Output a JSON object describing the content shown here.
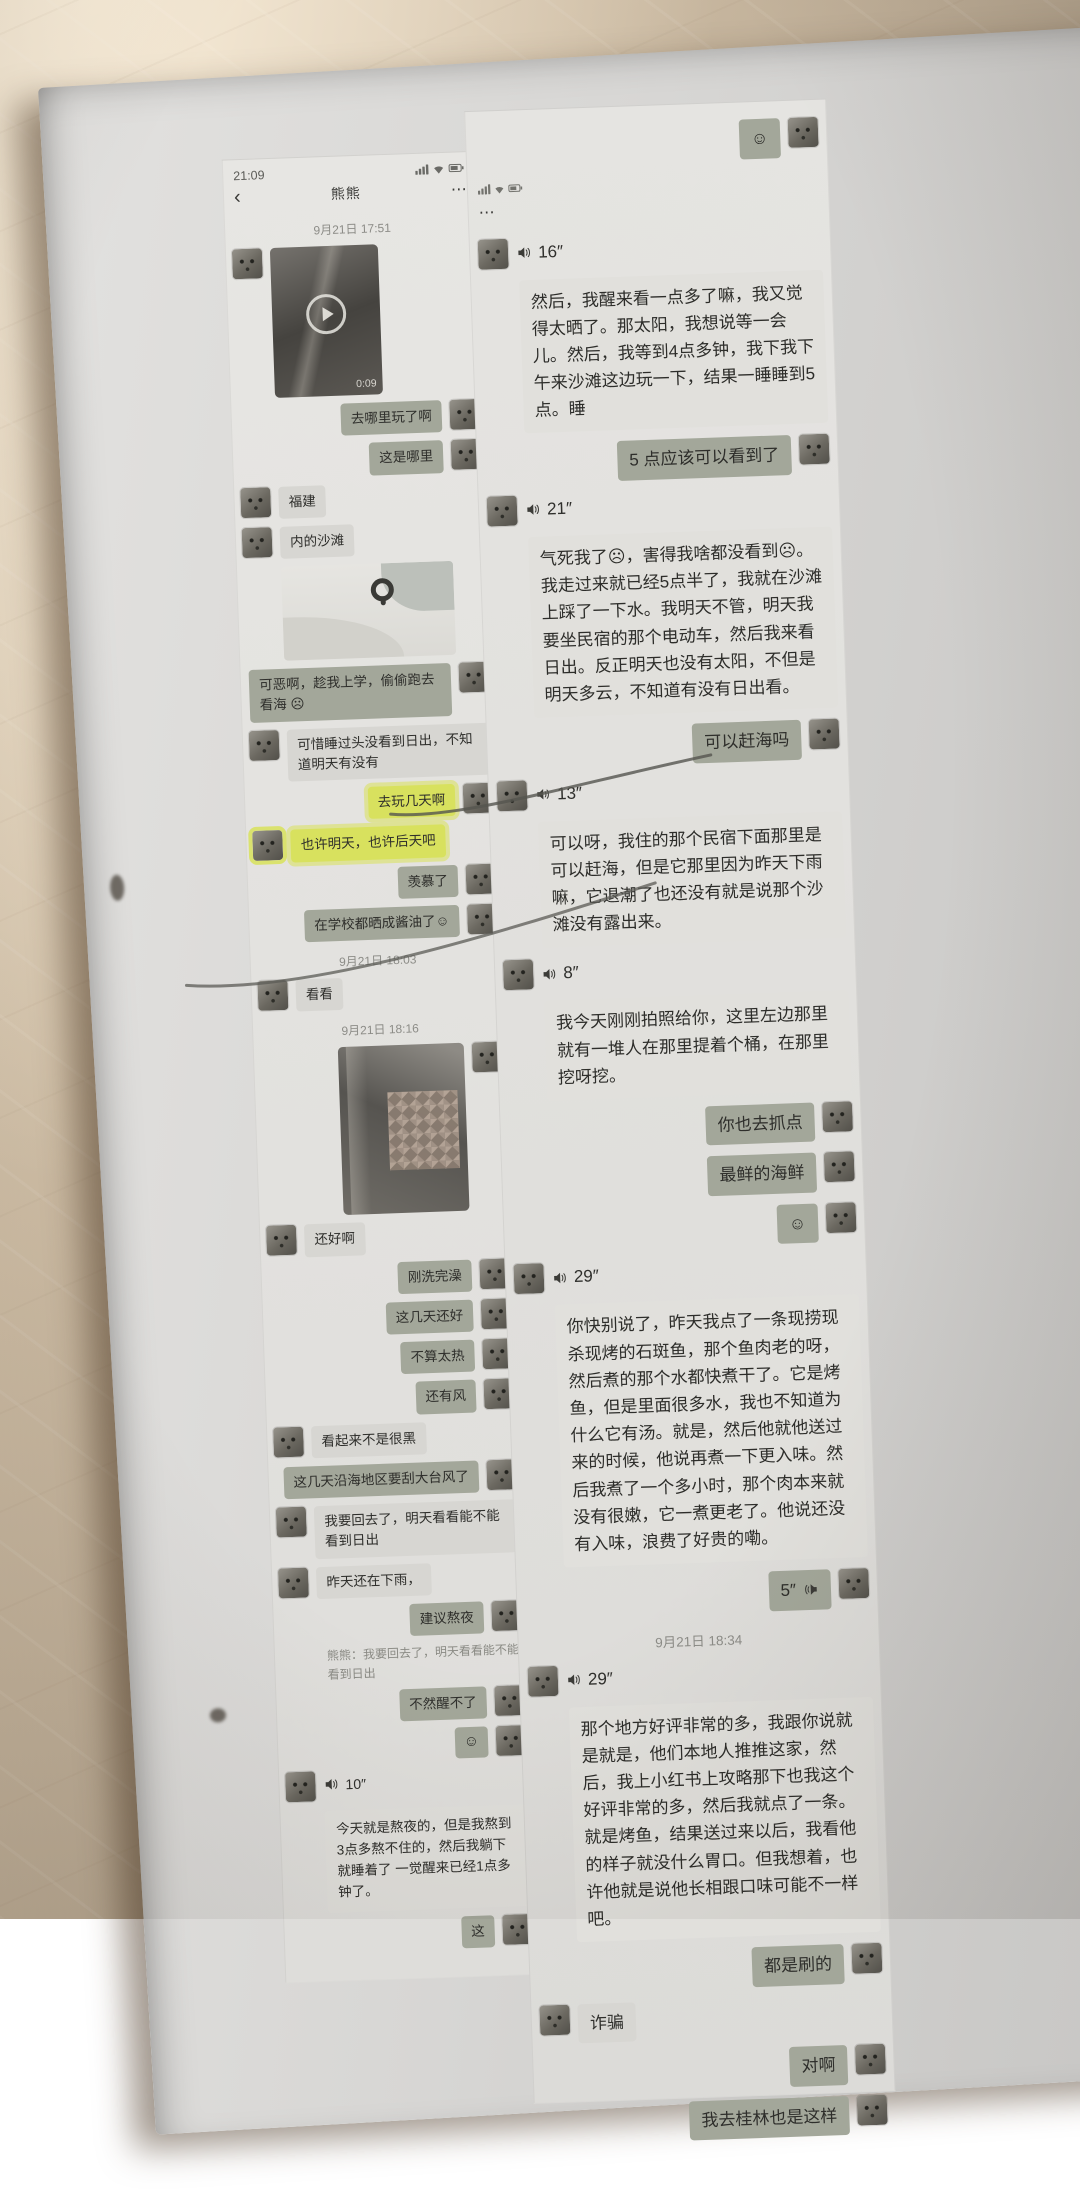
{
  "colors": {
    "table": "#c4b29b",
    "paper": "#d9d8d5",
    "highlighter": "#d8e15e",
    "bubble_in": "#d7d6d2",
    "bubble_out": "#a3a79a"
  },
  "left_chat": {
    "status_time": "21:09",
    "nav": {
      "back": "‹",
      "title": "熊熊",
      "menu": "⋯"
    },
    "messages": [
      {
        "type": "time",
        "text": "9月21日 17:51"
      },
      {
        "type": "video-in",
        "duration": "0:09"
      },
      {
        "type": "out",
        "text": "去哪里玩了啊"
      },
      {
        "type": "out",
        "text": "这是哪里"
      },
      {
        "type": "in",
        "text": "福建"
      },
      {
        "type": "in",
        "text": "内的沙滩"
      },
      {
        "type": "map-in"
      },
      {
        "type": "out",
        "text": "可恶啊，趁我上学，偷偷跑去看海 ☹"
      },
      {
        "type": "in",
        "text": "可惜睡过头没看到日出，不知道明天有没有"
      },
      {
        "type": "out",
        "text": "去玩几天啊",
        "highlight": true
      },
      {
        "type": "in",
        "text": "也许明天，也许后天吧",
        "highlight": true
      },
      {
        "type": "out",
        "text": "羡慕了"
      },
      {
        "type": "out",
        "text": "在学校都晒成酱油了☺"
      },
      {
        "type": "time",
        "text": "9月21日 18:03"
      },
      {
        "type": "in",
        "text": "看看"
      },
      {
        "type": "time",
        "text": "9月21日 18:16"
      },
      {
        "type": "photo-out"
      },
      {
        "type": "in",
        "text": "还好啊"
      },
      {
        "type": "out",
        "text": "刚洗完澡"
      },
      {
        "type": "out",
        "text": "这几天还好"
      },
      {
        "type": "out",
        "text": "不算太热"
      },
      {
        "type": "out",
        "text": "还有风"
      },
      {
        "type": "in",
        "text": "看起来不是很黑"
      },
      {
        "type": "out",
        "text": "这几天沿海地区要刮大台风了"
      },
      {
        "type": "in",
        "text": "我要回去了，明天看看能不能看到日出"
      },
      {
        "type": "in",
        "text": "昨天还在下雨，"
      },
      {
        "type": "out",
        "text": "建议熬夜"
      },
      {
        "type": "quote",
        "text": "熊熊：我要回去了，明天看看能不能看到日出"
      },
      {
        "type": "out",
        "text": "不然醒不了"
      },
      {
        "type": "out",
        "text": "☺",
        "emoji": true
      },
      {
        "type": "voice-in",
        "dur": "10″",
        "text": "今天就是熬夜的，但是我熬到3点多熬不住的，然后我躺下就睡着了 一觉醒来已经1点多钟了。"
      },
      {
        "type": "out",
        "text": "这"
      }
    ]
  },
  "right_chat": {
    "menu_dots": "⋯",
    "messages": [
      {
        "type": "out",
        "text": "☺",
        "emoji": true
      },
      {
        "type": "statusfrag"
      },
      {
        "type": "voice-in",
        "dur": "16″",
        "text": "然后，我醒来看一点多了嘛，我又觉得太晒了。那太阳，我想说等一会儿。然后，我等到4点多钟，我下我下午来沙滩这边玩一下，结果一睡睡到5点。睡"
      },
      {
        "type": "out",
        "text": "5 点应该可以看到了"
      },
      {
        "type": "voice-in",
        "dur": "21″",
        "text": "气死我了☹，害得我啥都没看到☹。我走过来就已经5点半了，我就在沙滩上踩了一下水。我明天不管，明天我要坐民宿的那个电动车，然后我来看日出。反正明天也没有太阳，不但是明天多云，不知道有没有日出看。"
      },
      {
        "type": "out",
        "text": "可以赶海吗"
      },
      {
        "type": "voice-in",
        "dur": "13″",
        "text": "可以呀，我住的那个民宿下面那里是可以赶海，但是它那里因为昨天下雨嘛，它退潮了也还没有就是说那个沙滩没有露出来。"
      },
      {
        "type": "voice-in",
        "dur": "8″",
        "text": "我今天刚刚拍照给你，这里左边那里就有一堆人在那里提着个桶，在那里挖呀挖。"
      },
      {
        "type": "out",
        "text": "你也去抓点"
      },
      {
        "type": "out",
        "text": "最鲜的海鲜"
      },
      {
        "type": "out",
        "text": "☺",
        "emoji": true
      },
      {
        "type": "voice-in",
        "dur": "29″",
        "text": "你快别说了，昨天我点了一条现捞现杀现烤的石斑鱼，那个鱼肉老的呀，然后煮的那个水都快煮干了。它是烤鱼，但是里面很多水，我也不知道为什么它有汤。就是，然后他就他送过来的时候，他说再煮一下更入味。然后我煮了一个多小时，那个肉本来就没有很嫩，它一煮更老了。他说还没有入味，浪费了好贵的嘞。"
      },
      {
        "type": "voice-out",
        "dur": "5″"
      },
      {
        "type": "time",
        "text": "9月21日 18:34"
      },
      {
        "type": "voice-in",
        "dur": "29″",
        "text": "那个地方好评非常的多，我跟你说就是就是，他们本地人推推这家，然后，我上小红书上攻略那下也我这个好评非常的多，然后我就点了一条。就是烤鱼，结果送过来以后，我看他的样子就没什么胃口。但我想着，也许他就是说他长相跟口味可能不一样吧。"
      },
      {
        "type": "out",
        "text": "都是刷的"
      },
      {
        "type": "in",
        "text": "诈骗"
      },
      {
        "type": "out",
        "text": "对啊"
      },
      {
        "type": "out",
        "text": "我去桂林也是这样"
      }
    ]
  }
}
